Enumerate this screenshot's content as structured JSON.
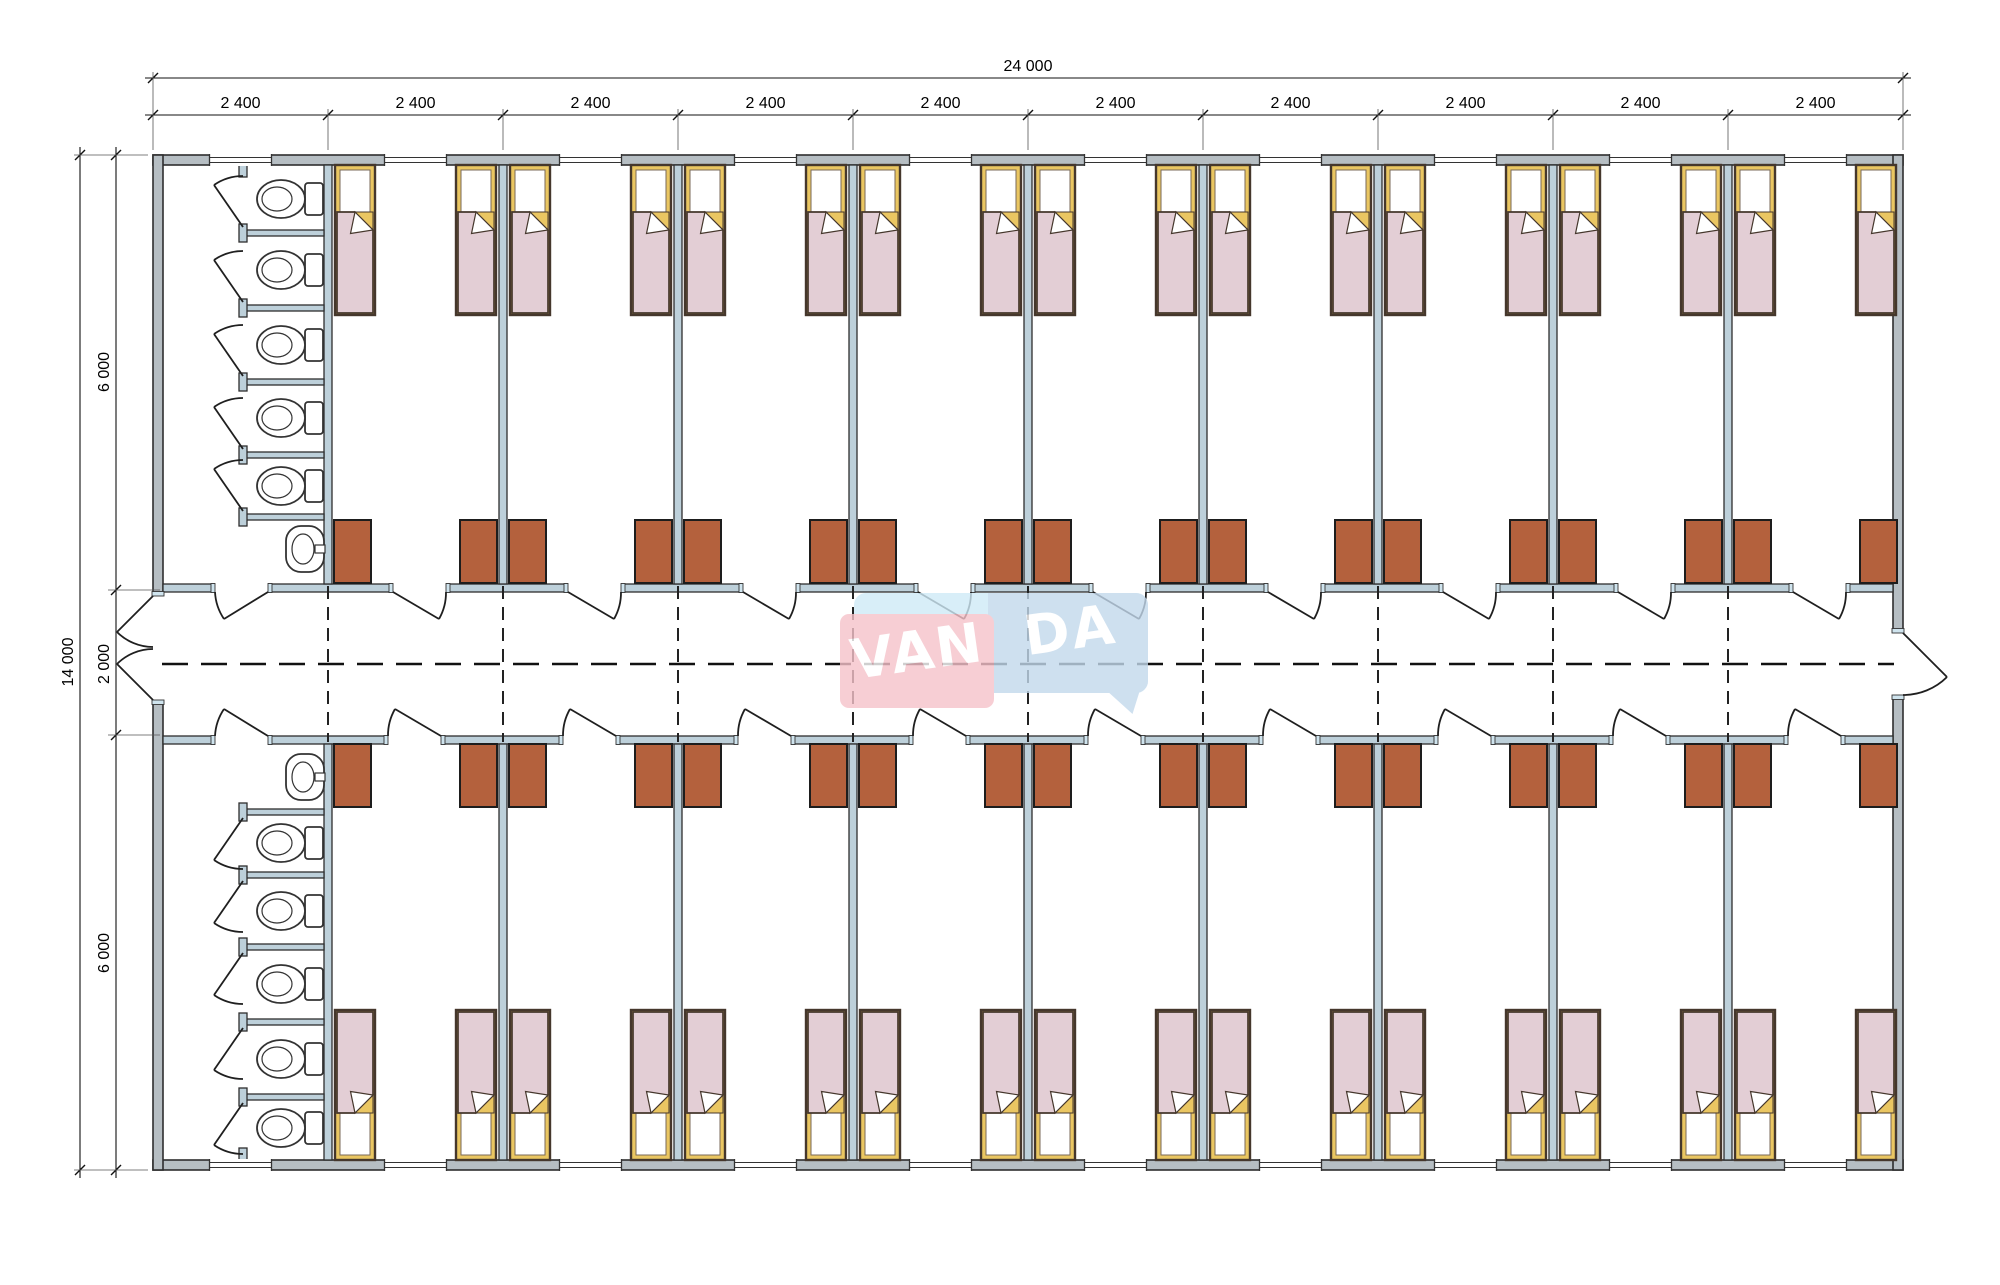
{
  "watermark": {
    "left": "VAN",
    "right": "DA"
  },
  "dimensions": {
    "total_width": "24 000",
    "bay_width": "2 400",
    "bay_count": 10,
    "total_height": "14 000",
    "room_depth_top": "6 000",
    "corridor_width": "2 000",
    "room_depth_bottom": "6 000"
  },
  "plan": {
    "rooms_top": 9,
    "rooms_bottom": 9,
    "beds_per_room": 2,
    "wardrobes_per_room": 2,
    "wc_top": {
      "toilets": 5,
      "sinks": 1
    },
    "wc_bottom": {
      "toilets": 5,
      "sinks": 1
    }
  },
  "colors": {
    "wall_fill": "#b6bec3",
    "wall_interior": "#bdd0da",
    "wall_stroke": "#2e2e2e",
    "jamb_fill": "#cfe4ee",
    "bed_frame": "#eac662",
    "bed_stroke": "#45372c",
    "blanket": "#e3ced5",
    "wardrobe": "#b4613d",
    "line": "#1f1f1f",
    "dim": "#111111",
    "watermark_pink": "#f6c2ca",
    "watermark_blue_light": "#cfeaf7",
    "watermark_blue": "#c3d9ec"
  }
}
